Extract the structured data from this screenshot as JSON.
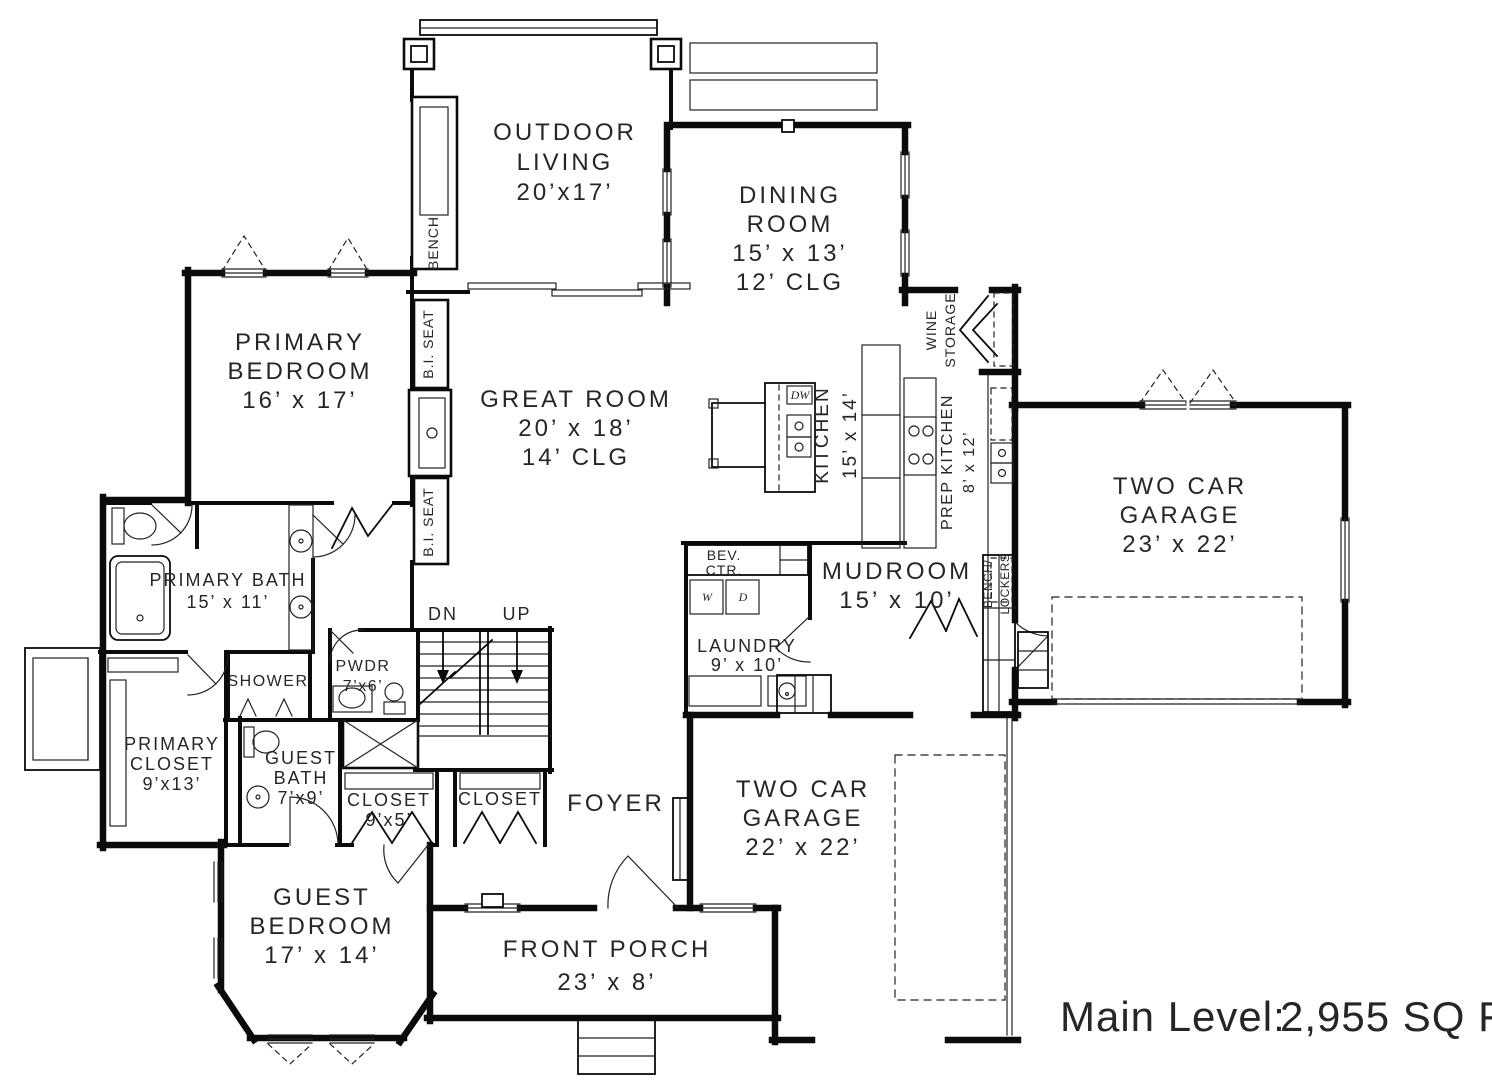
{
  "rooms": {
    "outdoor_living": {
      "lines": [
        "OUTDOOR",
        "LIVING",
        "20’x17’"
      ]
    },
    "dining_room": {
      "lines": [
        "DINING",
        "ROOM",
        "15’ x 13’",
        "12’ CLG"
      ]
    },
    "great_room": {
      "lines": [
        "GREAT ROOM",
        "20’ x 18’",
        "14’ CLG"
      ]
    },
    "primary_bedroom": {
      "lines": [
        "PRIMARY",
        "BEDROOM",
        "16’ x 17’"
      ]
    },
    "garage_right": {
      "lines": [
        "TWO CAR",
        "GARAGE",
        "23’ x 22’"
      ]
    },
    "mudroom": {
      "lines": [
        "MUDROOM",
        "15’ x 10’"
      ]
    },
    "garage_front": {
      "lines": [
        "TWO CAR",
        "GARAGE",
        "22’ x 22’"
      ]
    },
    "guest_bedroom": {
      "lines": [
        "GUEST",
        "BEDROOM",
        "17’ x 14’"
      ]
    },
    "front_porch": {
      "lines": [
        "FRONT PORCH",
        "23’ x 8’"
      ]
    },
    "foyer": {
      "lines": [
        "FOYER"
      ]
    },
    "primary_bath": {
      "lines": [
        "PRIMARY BATH",
        "15’ x 11’"
      ]
    },
    "primary_closet": {
      "lines": [
        "PRIMARY",
        "CLOSET",
        "9’x13’"
      ]
    },
    "guest_bath": {
      "lines": [
        "GUEST",
        "BATH",
        "7’x9’"
      ]
    },
    "closet_guest": {
      "lines": [
        "CLOSET",
        "9’x5’"
      ]
    },
    "closet_foyer": {
      "lines": [
        "CLOSET"
      ]
    },
    "laundry": {
      "lines": [
        "LAUNDRY",
        "9’ x 10’"
      ]
    },
    "powder": {
      "lines": [
        "PWDR",
        "7’x6’"
      ]
    },
    "shower": {
      "lines": [
        "SHOWER"
      ]
    },
    "kitchen": {
      "lines": [
        "KITCHEN",
        "15’ x 14’"
      ]
    },
    "prep_kitchen": {
      "lines": [
        "PREP KITCHEN",
        "8’ x 12’"
      ]
    },
    "wine_storage": {
      "lines": [
        "WINE",
        "STORAGE"
      ]
    },
    "bench_lockers": {
      "lines": [
        "BENCH/",
        "LOCKERS"
      ]
    },
    "bev_ctr": {
      "lines": [
        "BEV.",
        "CTR."
      ]
    },
    "bench": {
      "lines": [
        "BENCH"
      ]
    },
    "bi_seat_upper": {
      "lines": [
        "B.I. SEAT"
      ]
    },
    "bi_seat_lower": {
      "lines": [
        "B.I. SEAT"
      ]
    }
  },
  "stairs": {
    "dn": "DN",
    "up": "UP"
  },
  "appliances": {
    "washer": "W",
    "dryer": "D",
    "dishwasher": "DW"
  },
  "footer": {
    "label": "Main Level:",
    "value": "2,955 SQ FT",
    "label_color": "#7e9b55",
    "value_color": "#4d5156"
  }
}
